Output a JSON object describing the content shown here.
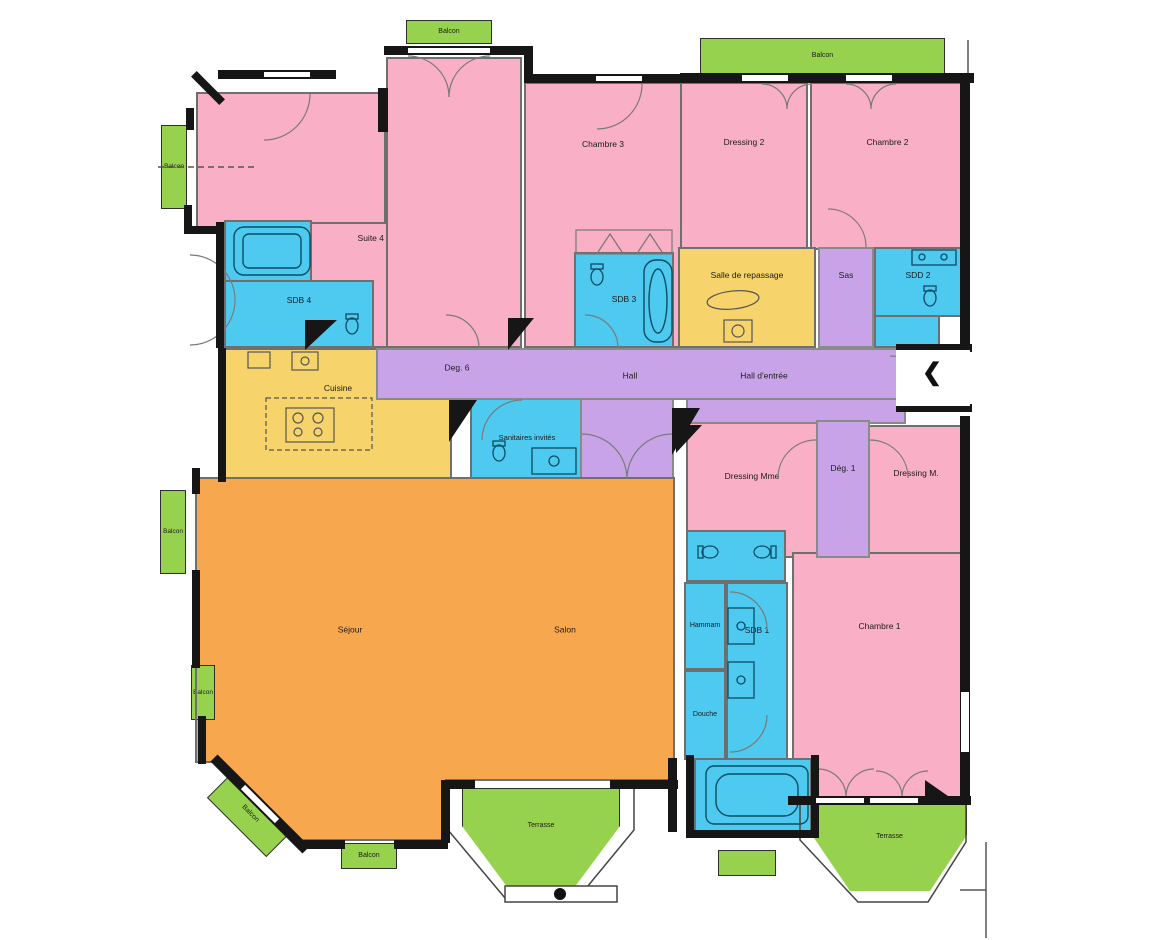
{
  "palette": {
    "pink": "#F9AFC5",
    "blue": "#4EC9F0",
    "yellow": "#F6D36B",
    "purple": "#C9A3E8",
    "orange": "#F7A74E",
    "green": "#97D24F",
    "wall": "#161616"
  },
  "rooms": {
    "suite4": "Suite 4",
    "sdb4": "SDB 4",
    "chambre3": "Chambre 3",
    "sdb3": "SDB 3",
    "dressing2": "Dressing 2",
    "chambre2": "Chambre 2",
    "salle_de_repassage": "Salle de repassage",
    "sas": "Sas",
    "sdd2": "SDD 2",
    "cuisine": "Cuisine",
    "deg6": "Deg. 6",
    "hall": "Hall",
    "hall_entree": "Hall d'entrée",
    "sanitaires_invites": "Sanitaires invités",
    "dressing_mme": "Dressing Mme",
    "deg1": "Dég. 1",
    "dressing_m": "Dressing M.",
    "sejour": "Séjour",
    "salon": "Salon",
    "hammam": "Hammam",
    "sdb1": "SDB 1",
    "douche": "Douche",
    "chambre1": "Chambre 1"
  },
  "outdoor": {
    "balcon": "Balcon",
    "terrasse": "Terrasse"
  },
  "entrance": {
    "chevron": "❮"
  }
}
